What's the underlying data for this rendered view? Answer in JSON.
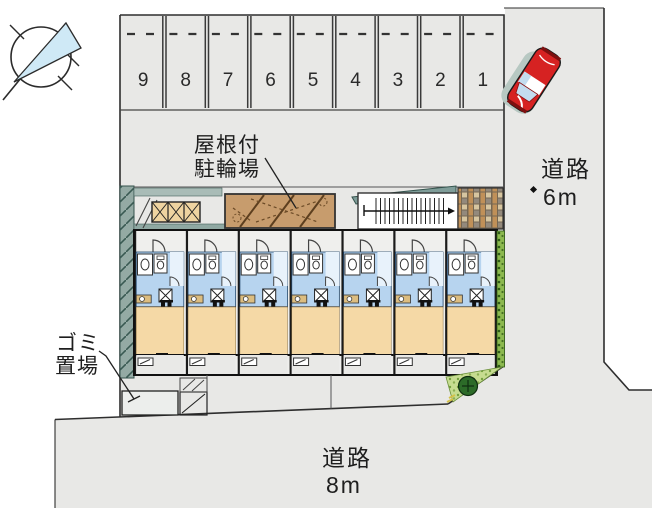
{
  "plan": {
    "parking": {
      "space_numbers": [
        "9",
        "8",
        "7",
        "6",
        "5",
        "4",
        "3",
        "2",
        "1"
      ]
    },
    "labels": {
      "bike_shed": {
        "line1": "屋根付",
        "line2": "駐輪場"
      },
      "garbage": {
        "line1": "ゴミ",
        "line2": "置場"
      },
      "road_east": {
        "line1": "道路",
        "line2": "6m"
      },
      "road_south": {
        "line1": "道路",
        "line2": "8m"
      }
    },
    "icons": {
      "compass": "north-arrow-icon",
      "car": "car-icon",
      "bush": "bush-icon"
    },
    "colors": {
      "road_fill": "#e8e8e6",
      "outline": "#2e2e2e",
      "building_floor": "#efefed",
      "unit_water_area": "#b7d4ef",
      "unit_room": "#f5d9a6",
      "balcony": "#e9e9e7",
      "wall_teal": "#94aaa4",
      "bike_shed_brown": "#c79c6d",
      "storage_tan": "#eed3a0",
      "hedge_green": "#8cb94f",
      "ground_cover_green": "#c6dc90",
      "bush_green": "#2c6b28",
      "car_red": "#d62222",
      "car_glass": "#c3dcef",
      "compass_fill": "#cfe9f6"
    }
  }
}
